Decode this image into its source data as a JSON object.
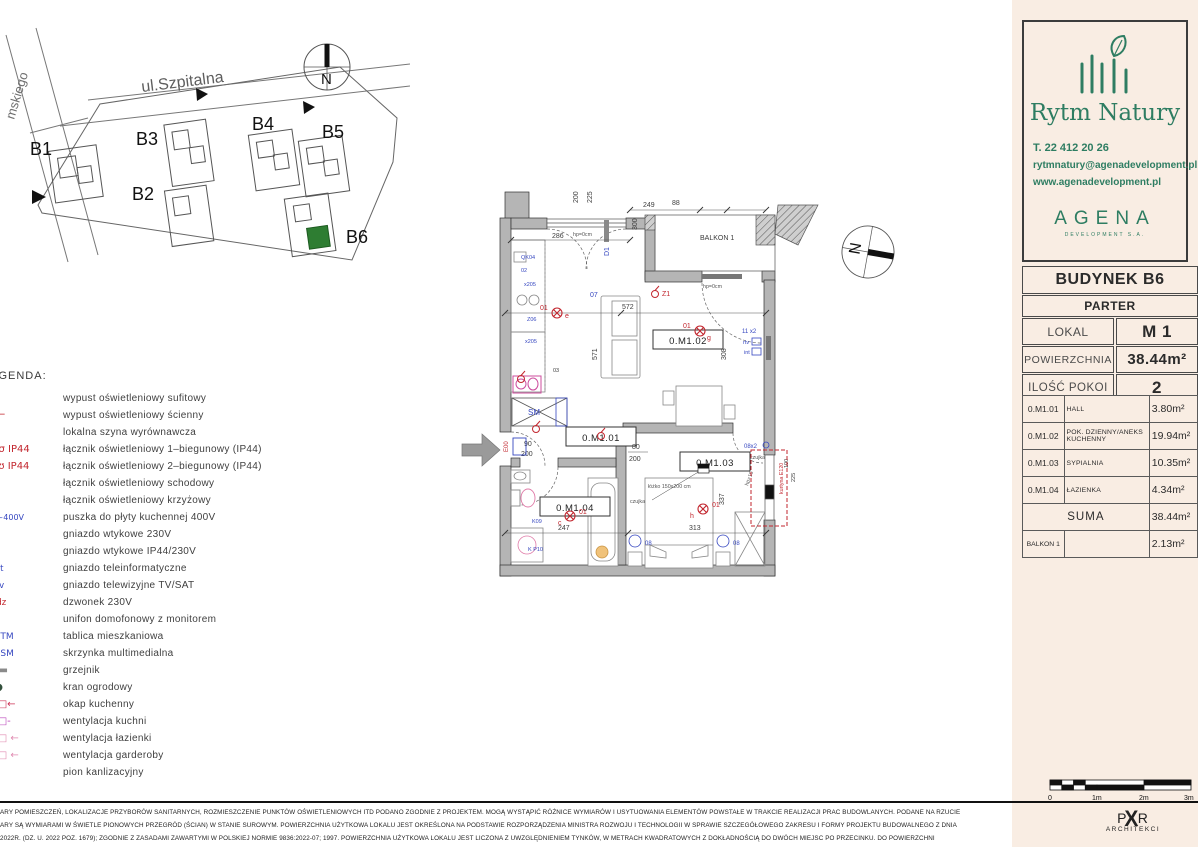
{
  "site_plan": {
    "street_top": "ul.Szpitalna",
    "street_left": "mskiego",
    "north": "N",
    "buildings": [
      {
        "label": "B1"
      },
      {
        "label": "B2"
      },
      {
        "label": "B3"
      },
      {
        "label": "B4"
      },
      {
        "label": "B5"
      },
      {
        "label": "B6"
      }
    ],
    "highlight_color": "#2e7d32"
  },
  "legend": {
    "title": "LEGENDA:",
    "items": [
      {
        "icon": "ceiling-light-icon",
        "glyph": "⊗",
        "color": "#c2262e",
        "label": "wypust oświetleniowy sufitowy"
      },
      {
        "icon": "wall-light-icon",
        "glyph": "∽⌐",
        "color": "#c2262e",
        "label": "wypust oświetleniowy ścienny"
      },
      {
        "icon": "equipotential-bar-icon",
        "glyph": "⊕",
        "color": "#d98e00",
        "label": "lokalna szyna wyrównawcza"
      },
      {
        "icon": "switch-1pole-icon",
        "glyph": "σ σ IP44",
        "color": "#c2262e",
        "label": "łącznik oświetleniowy 1–biegunowy (IP44)"
      },
      {
        "icon": "switch-2pole-icon",
        "glyph": "ʊ ʊ IP44",
        "color": "#c2262e",
        "label": "łącznik oświetleniowy 2–biegunowy (IP44)"
      },
      {
        "icon": "stair-switch-icon",
        "glyph": "ς",
        "color": "#c2262e",
        "label": "łącznik oświetleniowy schodowy"
      },
      {
        "icon": "cross-switch-icon",
        "glyph": "Ж",
        "color": "#c2262e",
        "label": "łącznik oświetleniowy krzyżowy"
      },
      {
        "icon": "cooker-box-icon",
        "glyph": "□~400V",
        "color": "#3647c0",
        "label": "puszka do płyty kuchennej 400V"
      },
      {
        "icon": "socket-230v-icon",
        "glyph": "⊂",
        "color": "#c2262e",
        "label": "gniazdo wtykowe 230V"
      },
      {
        "icon": "socket-ip44-icon",
        "glyph": "⋐",
        "color": "#c2262e",
        "label": "gniazdo wtykowe IP44/230V"
      },
      {
        "icon": "data-socket-icon",
        "glyph": "[int",
        "color": "#3647c0",
        "label": "gniazdo teleinformatyczne"
      },
      {
        "icon": "tv-sat-socket-icon",
        "glyph": "[rtv",
        "color": "#3647c0",
        "label": "gniazdo telewizyjne TV/SAT"
      },
      {
        "icon": "doorbell-icon",
        "glyph": "◉dz",
        "color": "#c2262e",
        "label": "dzwonek 230V"
      },
      {
        "icon": "intercom-icon",
        "glyph": "⊡",
        "color": "#3647c0",
        "label": "unifon domofonowy z monitorem"
      },
      {
        "icon": "apartment-panel-icon",
        "glyph": "□ TM",
        "color": "#3647c0",
        "label": "tablica mieszkaniowa"
      },
      {
        "icon": "multimedia-box-icon",
        "glyph": "□ SM",
        "color": "#3647c0",
        "label": "skrzynka multimedialna"
      },
      {
        "icon": "radiator-icon",
        "glyph": "▬▬",
        "color": "#8a8a8a",
        "label": "grzejnik"
      },
      {
        "icon": "garden-tap-icon",
        "glyph": "⊦●",
        "color": "#33503c",
        "label": "kran ogrodowy"
      },
      {
        "icon": "kitchen-hood-icon",
        "glyph": "○□←",
        "color": "#cc3355",
        "label": "okap kuchenny"
      },
      {
        "icon": "kitchen-vent-icon",
        "glyph": "○□-",
        "color": "#bb44bb",
        "label": "wentylacja kuchni"
      },
      {
        "icon": "bathroom-vent-icon",
        "glyph": "○□ ←",
        "color": "#e08ab0",
        "label": "wentylacja łazienki"
      },
      {
        "icon": "wardrobe-vent-icon",
        "glyph": "○□ ←",
        "color": "#e08ab0",
        "label": "wentylacja garderoby"
      },
      {
        "icon": "sewage-riser-icon",
        "glyph": "⊕",
        "color": "#333333",
        "label": "pion kanlizacyjny"
      }
    ]
  },
  "plan": {
    "north": "N",
    "rooms": {
      "r1": "0.M1.01",
      "r2": "0.M1.02",
      "r3": "0.M1.03",
      "r4": "0.M1.04"
    },
    "balkon": "BALKON 1",
    "dims": {
      "d286": "286",
      "d200": "200",
      "d225": "225",
      "d249": "249",
      "d88": "88",
      "d300": "300",
      "d572": "572",
      "d571": "571",
      "d308": "308",
      "d247": "247",
      "d313": "313",
      "d337": "337",
      "d80": "80",
      "d200b": "200",
      "d90": "90",
      "d200c": "200",
      "d100": "100",
      "d225b": "225"
    },
    "notes": {
      "hp0a": "hp=0cm",
      "hp0b": "hp=0cm",
      "hp15": "hp=15",
      "bed": "łóżko 150x200 cm",
      "czujka1": "czujka",
      "czujka2": "czujka",
      "kurtyna": "kurtyna E120"
    },
    "symbols": {
      "e00": "E00",
      "d1": "D1",
      "z1": "Z1",
      "sm": "SM",
      "s01a": "01",
      "se": "e",
      "s01b": "01",
      "sg": "g",
      "s01c": "01",
      "sc": "c",
      "s01d": "01",
      "sh": "h",
      "s07": "07",
      "s08a": "08",
      "s08b": "08",
      "s08x2": "08x2",
      "s11x2": "11 x2",
      "rtv": "rtv",
      "int": "int",
      "qk04": "QK04",
      "s02": "02",
      "x205a": "x205",
      "z06": "Z06",
      "x205b": "x205",
      "s03": "03",
      "k09": "K09",
      "kp10": "K P10"
    }
  },
  "brand": {
    "name": "Rytm Natury",
    "phone": "T. 22 412 20 26",
    "email": "rytmnatury@agenadevelopment.pl",
    "website": "www.agenadevelopment.pl",
    "developer": "AGENA",
    "developer_sub": "DEVELOPMENT S.A."
  },
  "info": {
    "building": "BUDYNEK B6",
    "floor": "PARTER",
    "lokal_label": "LOKAL",
    "lokal_value": "M 1",
    "area_label": "POWIERZCHNIA",
    "area_value": "38.44m²",
    "rooms_label": "ILOŚĆ POKOI",
    "rooms_value": "2",
    "rooms": [
      {
        "code": "0.M1.01",
        "name": "HALL",
        "area": "3.80m²"
      },
      {
        "code": "0.M1.02",
        "name": "POK. DZIENNY/ANEKS KUCHENNY",
        "area": "19.94m²"
      },
      {
        "code": "0.M1.03",
        "name": "SYPIALNIA",
        "area": "10.35m²"
      },
      {
        "code": "0.M1.04",
        "name": "ŁAZIENKA",
        "area": "4.34m²"
      }
    ],
    "suma_label": "SUMA",
    "suma_value": "38.44m²",
    "balkon_label": "BALKON 1",
    "balkon_value": "2.13m²"
  },
  "footer": {
    "line1": "ARY POMIESZCZEŃ, LOKALIZACJE PRZYBORÓW SANITARNYCH, ROZMIESZCZENIE PUNKTÓW OŚWIETLENIOWYCH ITD PODANO ZGODNIE Z PROJEKTEM. MOGĄ WYSTĄPIĆ RÓŻNICE WYMIARÓW I USYTUOWANIA ELEMENTÓW POWSTAŁE W TRAKCIE REALIZACJI PRAC BUDOWLANYCH. PODANE NA RZUCIE",
    "line2": "ARY SĄ WYMIARAMI W ŚWIETLE PIONOWYCH PRZEGRÓD (ŚCIAN) W STANIE SUROWYM. POWIERZCHNIA UŻYTKOWA LOKALU JEST OKREŚLONA NA PODSTAWIE ROZPORZĄDZENIA MINISTRA ROZWOJU I TECHNOLOGII W SPRAWIE SZCZEGÓŁOWEGO ZAKRESU I FORMY PROJEKTU BUDOWALNEGO Z DNIA",
    "line3": "2022R. (DZ. U. 2022 POZ. 1679); ZGODNIE Z ZASADAMI ZAWARTYMI W POLSKIEJ NORMIE  9836:2022-07; 1997. POWIERZCHNIA UŻYTKOWA LOKALU JEST LICZONA Z UWZGLĘDNIENIEM TYNKÓW, W METRACH KWADRATOWYCH Z DOKŁADNOŚCIĄ DO DWÓCH MIEJSC PO PRZECINKU. DO POWIERZCHNI",
    "scale_ticks": [
      "0",
      "1m",
      "2m",
      "3m"
    ],
    "architect_p": "P",
    "architect_x": "X",
    "architect_r": "R",
    "architect_sub": "ARCHITEKCI"
  }
}
